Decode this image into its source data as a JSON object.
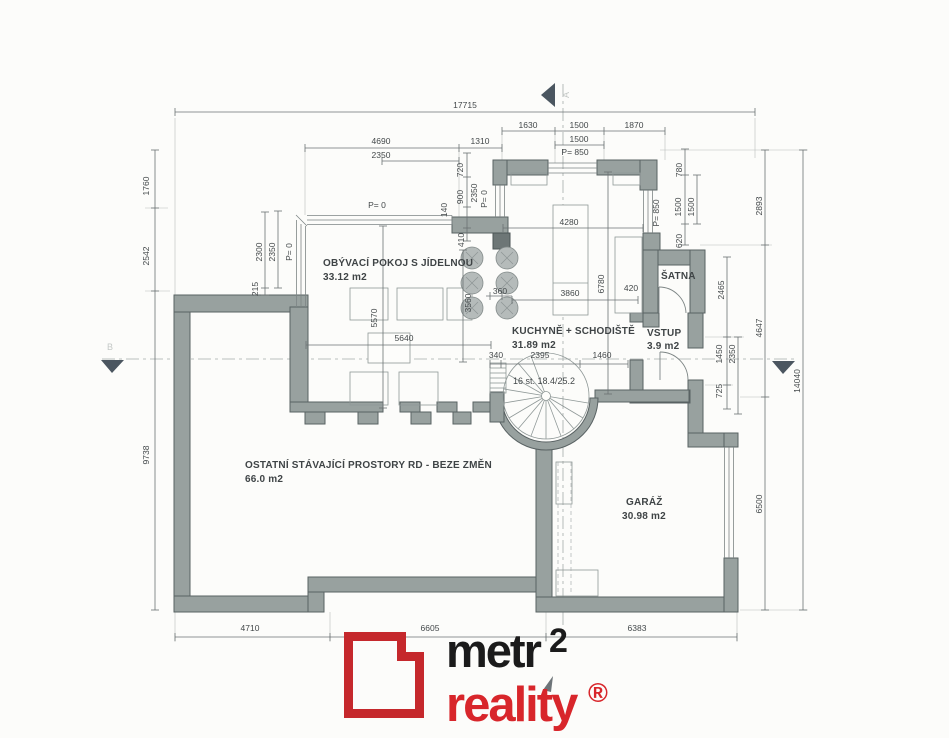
{
  "rooms": {
    "living": {
      "name": "OBÝVACÍ POKOJ S JÍDELNOU",
      "area": "33.12 m2"
    },
    "kitchen": {
      "name": "KUCHYNĚ + SCHODIŠTĚ",
      "area": "31.89 m2"
    },
    "wardrobe": {
      "name": "ŠATNA"
    },
    "entry": {
      "name": "VSTUP",
      "area": "3.9 m2"
    },
    "existing": {
      "name": "OSTATNÍ STÁVAJÍCÍ PROSTORY RD - BEZE ZMĚN",
      "area": "66.0 m2"
    },
    "garage": {
      "name": "GARÁŽ",
      "area": "30.98 m2"
    },
    "stairs_note": "16 st. 18.4/25.2"
  },
  "dims": {
    "total_width": "17715",
    "a4690": "4690",
    "a1310": "1310",
    "a2350": "2350",
    "b1630": "1630",
    "b1500": "1500",
    "b1870": "1870",
    "b1500b": "1500",
    "p850": "P= 850",
    "l1760": "1760",
    "l2542": "2542",
    "l9738": "9738",
    "w2300": "2300",
    "w2350": "2350",
    "p0": "P= 0",
    "w215": "215",
    "k720": "720",
    "k900": "900",
    "k2350": "2350",
    "k140": "140",
    "k410": "410",
    "k4280": "4280",
    "k3860": "3860",
    "k360": "360",
    "k3560": "3560",
    "k6780": "6780",
    "k420": "420",
    "s340": "340",
    "s2395": "2395",
    "s1460": "1460",
    "lv5570": "5570",
    "lv5640": "5640",
    "r780": "780",
    "r1500a": "1500",
    "r1500b": "1500",
    "r620": "620",
    "rp850": "P= 850",
    "r2465": "2465",
    "r1450": "1450",
    "r2350": "2350",
    "r725": "725",
    "r2893": "2893",
    "r4647": "4647",
    "r6500": "6500",
    "r14040": "14040",
    "bt4710": "4710",
    "bt6605": "6605",
    "bt6383": "6383"
  },
  "markers": {
    "section_a": "A",
    "section_b": "B"
  },
  "logo": {
    "word1": "metr",
    "sup": "2",
    "word2": "reality",
    "reg": "®"
  },
  "colors": {
    "wall_fill": "#98a19f",
    "logo_square_red": "#c5282c",
    "logo_text_red": "#d8262b",
    "logo_black": "#1b1b1b",
    "dim_text": "#43484a"
  }
}
